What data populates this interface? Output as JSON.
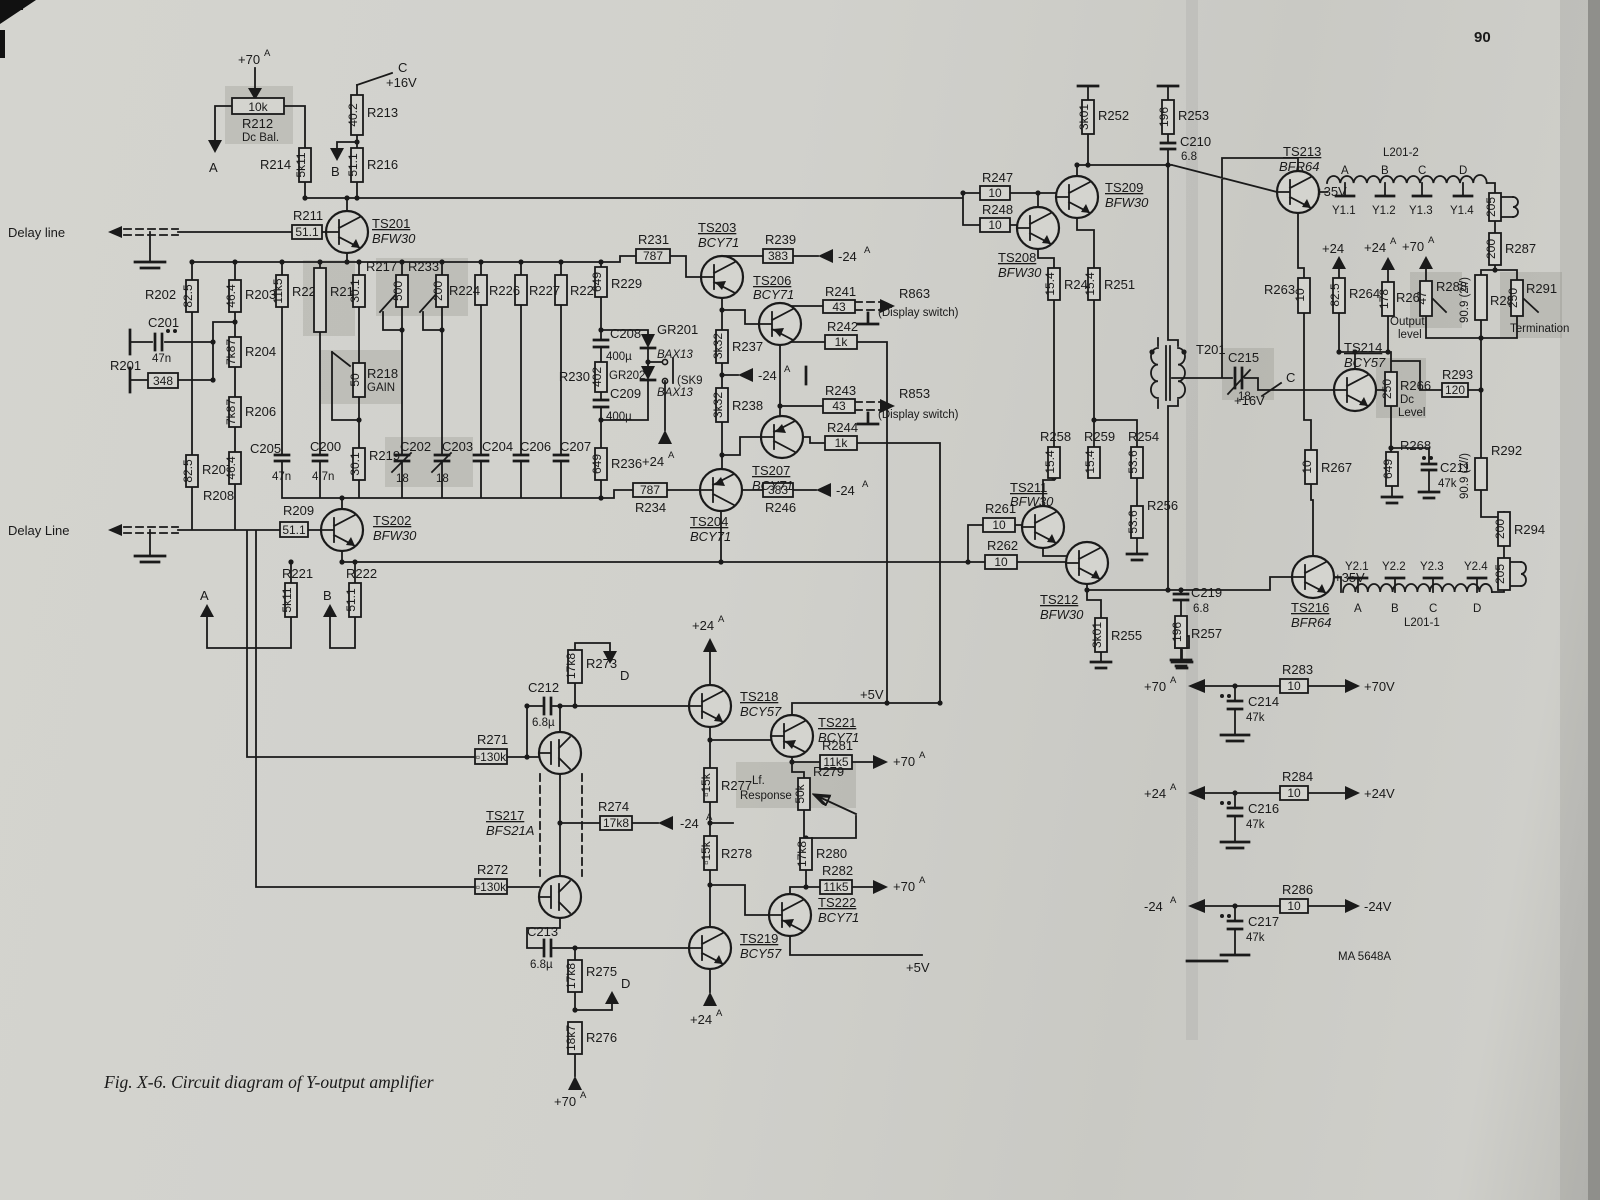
{
  "page": {
    "number": "90",
    "caption": "Fig. X-6.  Circuit diagram of Y-output amplifier",
    "code": "MA 5648A"
  },
  "x": {
    "A": "A",
    "B": "B",
    "C": "C",
    "D": "D",
    "p70": "+70",
    "p24": "+24",
    "m24": "-24",
    "p5v": "+5V",
    "p16v": "+16V",
    "p35v": "+35V",
    "p70v": "+70V",
    "p24v": "+24V",
    "m24v": "-24V",
    "delay_top": "Delay line",
    "delay_bot": "Delay Line",
    "sk9": "(SK9",
    "t201": "T201",
    "l2012": "L201-2",
    "l2011": "L201-1",
    "y11": "Y1.1",
    "y12": "Y1.2",
    "y13": "Y1.3",
    "y14": "Y1.4",
    "y21": "Y2.1",
    "y22": "Y2.2",
    "y23": "Y2.3",
    "y24": "Y2.4",
    "r863": "R863",
    "r853": "R853",
    "dsw": "(Display switch)",
    "gain": "GAIN",
    "dcbal": "Dc Bal.",
    "dc": "Dc",
    "level": "Level",
    "out": "Output",
    "outl": "level",
    "term": "Termination",
    "lf": "Lf.",
    "resp": "Response",
    "v909": "90.9 (2//)"
  },
  "c": {
    "r201": [
      "R201",
      "348"
    ],
    "r202": [
      "R202",
      "82.5"
    ],
    "r203": [
      "R203",
      "46.4"
    ],
    "r204": [
      "R204",
      "7k87"
    ],
    "r206": [
      "R206",
      "7k87"
    ],
    "r207": [
      "R207",
      "82.5"
    ],
    "r208": [
      "R208",
      "46.4"
    ],
    "r209": [
      "R209",
      "51.1"
    ],
    "r211": [
      "R211",
      "51.1"
    ],
    "r212": [
      "R212",
      "10k"
    ],
    "r213": [
      "R213",
      "40.2"
    ],
    "r214": [
      "R214",
      "5k11"
    ],
    "r215": [
      "R215",
      ""
    ],
    "r216": [
      "R216",
      "51.1"
    ],
    "r217": [
      "R217",
      "500"
    ],
    "r218": [
      "R218",
      "50"
    ],
    "r219": [
      "R219",
      "30.1"
    ],
    "r220": [
      "R220",
      "11k5"
    ],
    "r221": [
      "R221",
      "5k11"
    ],
    "r222": [
      "R222",
      "51.1"
    ],
    "r224": [
      "R224",
      ""
    ],
    "r226": [
      "R226",
      ""
    ],
    "r227": [
      "R227",
      ""
    ],
    "r228": [
      "R228",
      ""
    ],
    "r229": [
      "R229",
      "649"
    ],
    "r230": [
      "R230",
      "402"
    ],
    "r231": [
      "R231",
      "787"
    ],
    "r233": [
      "R233",
      "200"
    ],
    "r234": [
      "R234",
      "787"
    ],
    "r236": [
      "R236",
      "649"
    ],
    "r237": [
      "R237",
      "3k32"
    ],
    "r238": [
      "R238",
      "3k32"
    ],
    "r239": [
      "R239",
      "383"
    ],
    "r241": [
      "R241",
      "43"
    ],
    "r242": [
      "R242",
      "1k"
    ],
    "r243": [
      "R243",
      "43"
    ],
    "r244": [
      "R244",
      "1k"
    ],
    "r246": [
      "R246",
      "383"
    ],
    "r247": [
      "R247",
      "10"
    ],
    "r248": [
      "R248",
      "10"
    ],
    "r249": [
      "R249",
      "15.4"
    ],
    "r251": [
      "R251",
      "15.4"
    ],
    "r252": [
      "R252",
      "3k01"
    ],
    "r253": [
      "R253",
      "196"
    ],
    "r254": [
      "R254",
      "53.6"
    ],
    "r255": [
      "R255",
      "3k01"
    ],
    "r256": [
      "R256",
      "53.6"
    ],
    "r257": [
      "R257",
      "196"
    ],
    "r258": [
      "R258",
      "15.4"
    ],
    "r259": [
      "R259",
      "15.4"
    ],
    "r261": [
      "R261",
      "10"
    ],
    "r262": [
      "R262",
      "10"
    ],
    "r263": [
      "R263",
      "10"
    ],
    "r264": [
      "R264",
      "82.5"
    ],
    "r266": [
      "R266",
      "250"
    ],
    "r267": [
      "R267",
      "10"
    ],
    "r268": [
      "R268",
      "649"
    ],
    "r269": [
      "R269",
      "178"
    ],
    "r271": [
      "R271",
      "▫130k"
    ],
    "r272": [
      "R272",
      "▫130k"
    ],
    "r273": [
      "R273",
      "17k8"
    ],
    "r274": [
      "R274",
      "17k8"
    ],
    "r275": [
      "R275",
      "17k8"
    ],
    "r276": [
      "R276",
      "18k7"
    ],
    "r277": [
      "R277",
      "▫15k"
    ],
    "r278": [
      "R278",
      "▫15k"
    ],
    "r279": [
      "R279",
      "50k"
    ],
    "r280": [
      "R280",
      "17k8"
    ],
    "r281": [
      "R281",
      "11k5"
    ],
    "r282": [
      "R282",
      "11k5"
    ],
    "r283": [
      "R283",
      "10"
    ],
    "r284": [
      "R284",
      "10"
    ],
    "r286": [
      "R286",
      "10"
    ],
    "r287": [
      "R287",
      "200"
    ],
    "r288": [
      "R288",
      "47"
    ],
    "r289": [
      "R289",
      ""
    ],
    "r291": [
      "R291",
      "250"
    ],
    "r292": [
      "R292",
      ""
    ],
    "r293": [
      "R293",
      "120"
    ],
    "r294": [
      "R294",
      "200"
    ],
    "l205a": [
      "",
      "205"
    ],
    "l205b": [
      "",
      "205"
    ],
    "rb30": [
      "",
      "30.1"
    ],
    "c200": [
      "C200",
      "4.7n"
    ],
    "c201": [
      "C201",
      "47n"
    ],
    "c202": [
      "C202",
      "18"
    ],
    "c203": [
      "C203",
      "18"
    ],
    "c204": [
      "C204",
      ""
    ],
    "c205": [
      "C205",
      "47n"
    ],
    "c206": [
      "C206",
      ""
    ],
    "c207": [
      "C207",
      ""
    ],
    "c208": [
      "C208",
      "400µ"
    ],
    "c209": [
      "C209",
      "400µ"
    ],
    "c210": [
      "C210",
      "6.8"
    ],
    "c211": [
      "C211",
      "47k"
    ],
    "c212": [
      "C212",
      "6.8µ"
    ],
    "c213": [
      "C213",
      "6.8µ"
    ],
    "c214": [
      "C214",
      "47k"
    ],
    "c215": [
      "C215",
      "18"
    ],
    "c216": [
      "C216",
      "47k"
    ],
    "c217": [
      "C217",
      "47k"
    ],
    "c219": [
      "C219",
      "6.8"
    ]
  },
  "t": {
    "ts201": [
      "TS201",
      "BFW30"
    ],
    "ts202": [
      "TS202",
      "BFW30"
    ],
    "ts203": [
      "TS203",
      "BCY71"
    ],
    "ts204": [
      "TS204",
      "BCY71"
    ],
    "ts206": [
      "TS206",
      "BCY71"
    ],
    "ts207": [
      "TS207",
      "BCY71"
    ],
    "ts208": [
      "TS208",
      "BFW30"
    ],
    "ts209": [
      "TS209",
      "BFW30"
    ],
    "ts211": [
      "TS211",
      "BFW30"
    ],
    "ts212": [
      "TS212",
      "BFW30"
    ],
    "ts213": [
      "TS213",
      "BFR64"
    ],
    "ts214": [
      "TS214",
      "BCY57"
    ],
    "ts216": [
      "TS216",
      "BFR64"
    ],
    "ts217": [
      "TS217",
      "BFS21A"
    ],
    "ts218": [
      "TS218",
      "BCY57"
    ],
    "ts219": [
      "TS219",
      "BCY57"
    ],
    "ts221": [
      "TS221",
      "BCY71"
    ],
    "ts222": [
      "TS222",
      "BCY71"
    ]
  },
  "d": {
    "gr201": [
      "GR201",
      "BAX13"
    ],
    "gr202": [
      "GR202",
      "BAX13"
    ]
  }
}
